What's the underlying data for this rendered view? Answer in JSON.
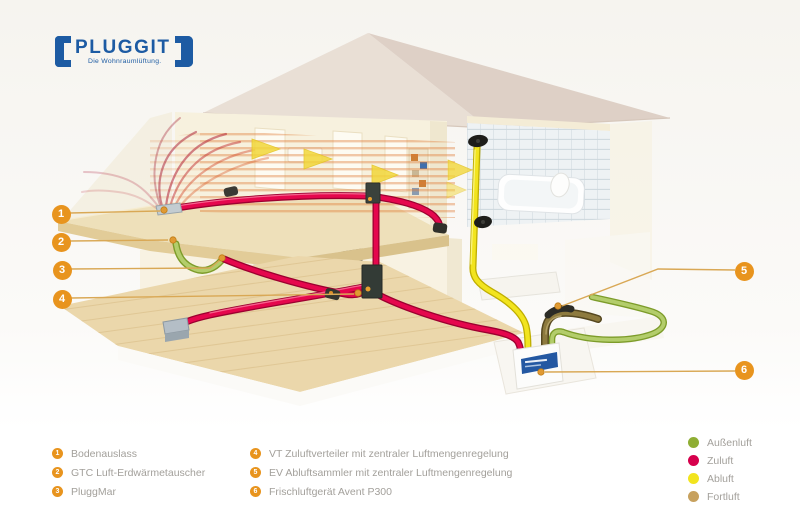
{
  "brand": {
    "name": "PLUGGIT",
    "tagline": "Die Wohnraumlüftung.",
    "color": "#1d5ba3"
  },
  "markers": [
    {
      "n": "1"
    },
    {
      "n": "2"
    },
    {
      "n": "3"
    },
    {
      "n": "4"
    },
    {
      "n": "5"
    },
    {
      "n": "6"
    }
  ],
  "component_legend": [
    {
      "num": "1",
      "label": "Bodenauslass"
    },
    {
      "num": "2",
      "label": "GTC Luft-Erdwärmetauscher"
    },
    {
      "num": "3",
      "label": "PluggMar"
    },
    {
      "num": "4",
      "label": "VT Zuluftverteiler mit zentraler Luftmengenregelung"
    },
    {
      "num": "5",
      "label": "EV Abluftsammler mit zentraler Luftmengenregelung"
    },
    {
      "num": "6",
      "label": "Frischluftgerät Avent P300"
    }
  ],
  "airflow_legend": [
    {
      "label": "Außenluft",
      "color": "#8fae34"
    },
    {
      "label": "Zuluft",
      "color": "#d6004c"
    },
    {
      "label": "Abluft",
      "color": "#f2e41e"
    },
    {
      "label": "Fortluft",
      "color": "#c7a15e"
    }
  ],
  "accent": {
    "marker_color": "#e8941e",
    "leader_color": "#d9a855"
  }
}
